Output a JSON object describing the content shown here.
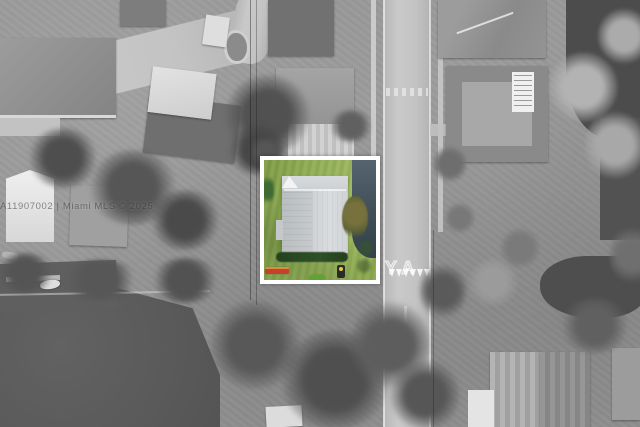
{
  "photo": {
    "watermarks": {
      "mls": "A11907002 | Miami MLS © 2025",
      "road": "YA"
    },
    "highlight": {
      "border_color": "#ffffff",
      "lawn_color": "#8fae4e",
      "roof_color": "#ccd0d3",
      "roof_gable_color": "#f3f3f3",
      "driveway_color": "#41505a",
      "hedge_color": "#2c4a26",
      "bush_color": "#61a135",
      "accent_object_color": "#c7402c",
      "marker_dot_color": "#e6c838"
    }
  }
}
